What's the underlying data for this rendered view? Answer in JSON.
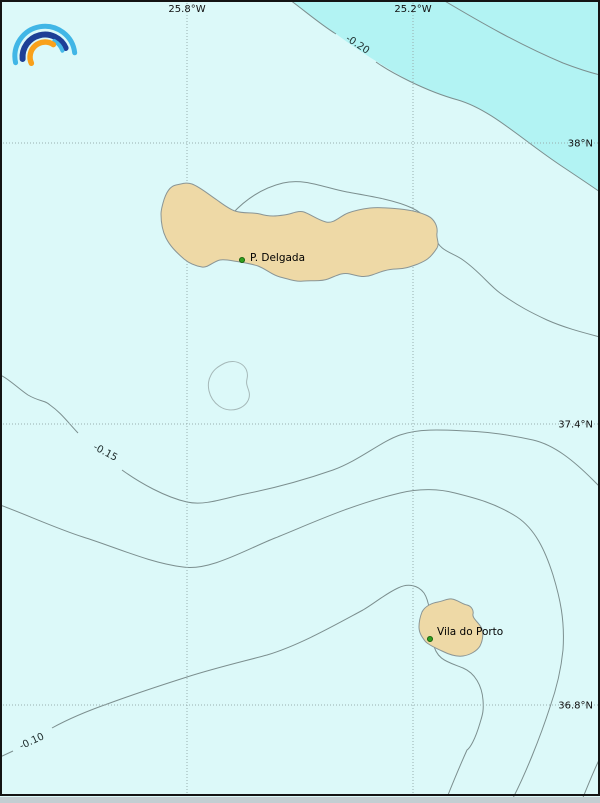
{
  "figure": {
    "width": 600,
    "height": 803,
    "kind": "geographic contour map"
  },
  "logo": {
    "name": "rainbow-arcs-logo",
    "outer_arc_color": "#41b6e6",
    "middle_arc_color": "#1e3f96",
    "inner_arc_color": "#f9a11b",
    "accent_arc_color": "#45b8e8"
  },
  "map": {
    "colors": {
      "sea": "#dcf9f9",
      "shaded_region": "#b2f3f3",
      "land": "#eed9a6",
      "land_border": "#8a9595",
      "contour": "#7c8f8f",
      "minor_contour": "#a5b8b8",
      "grid": "#98aeae",
      "frame": "#141414",
      "marker": "#2f9e1e",
      "marker_edge": "#145c0a"
    },
    "meridians": [
      {
        "label": "25.8°W",
        "x": 187
      },
      {
        "label": "25.2°W",
        "x": 413
      }
    ],
    "parallels": [
      {
        "label": "38°N",
        "y": 143
      },
      {
        "label": "37.4°N",
        "y": 424
      },
      {
        "label": "36.8°N",
        "y": 705
      }
    ],
    "contour_labels": [
      {
        "text": "-0.20",
        "x": 356,
        "y": 47,
        "rotation": 33
      },
      {
        "text": "-0.15",
        "x": 104,
        "y": 455,
        "rotation": 28
      },
      {
        "text": "-0.10",
        "x": 33,
        "y": 744,
        "rotation": -25
      }
    ],
    "places": [
      {
        "name": "P. Delgada",
        "dot_x": 242,
        "dot_y": 260,
        "label_x": 250,
        "label_y": 261
      },
      {
        "name": "Vila do Porto",
        "dot_x": 430,
        "dot_y": 639,
        "label_x": 437,
        "label_y": 635
      }
    ]
  }
}
